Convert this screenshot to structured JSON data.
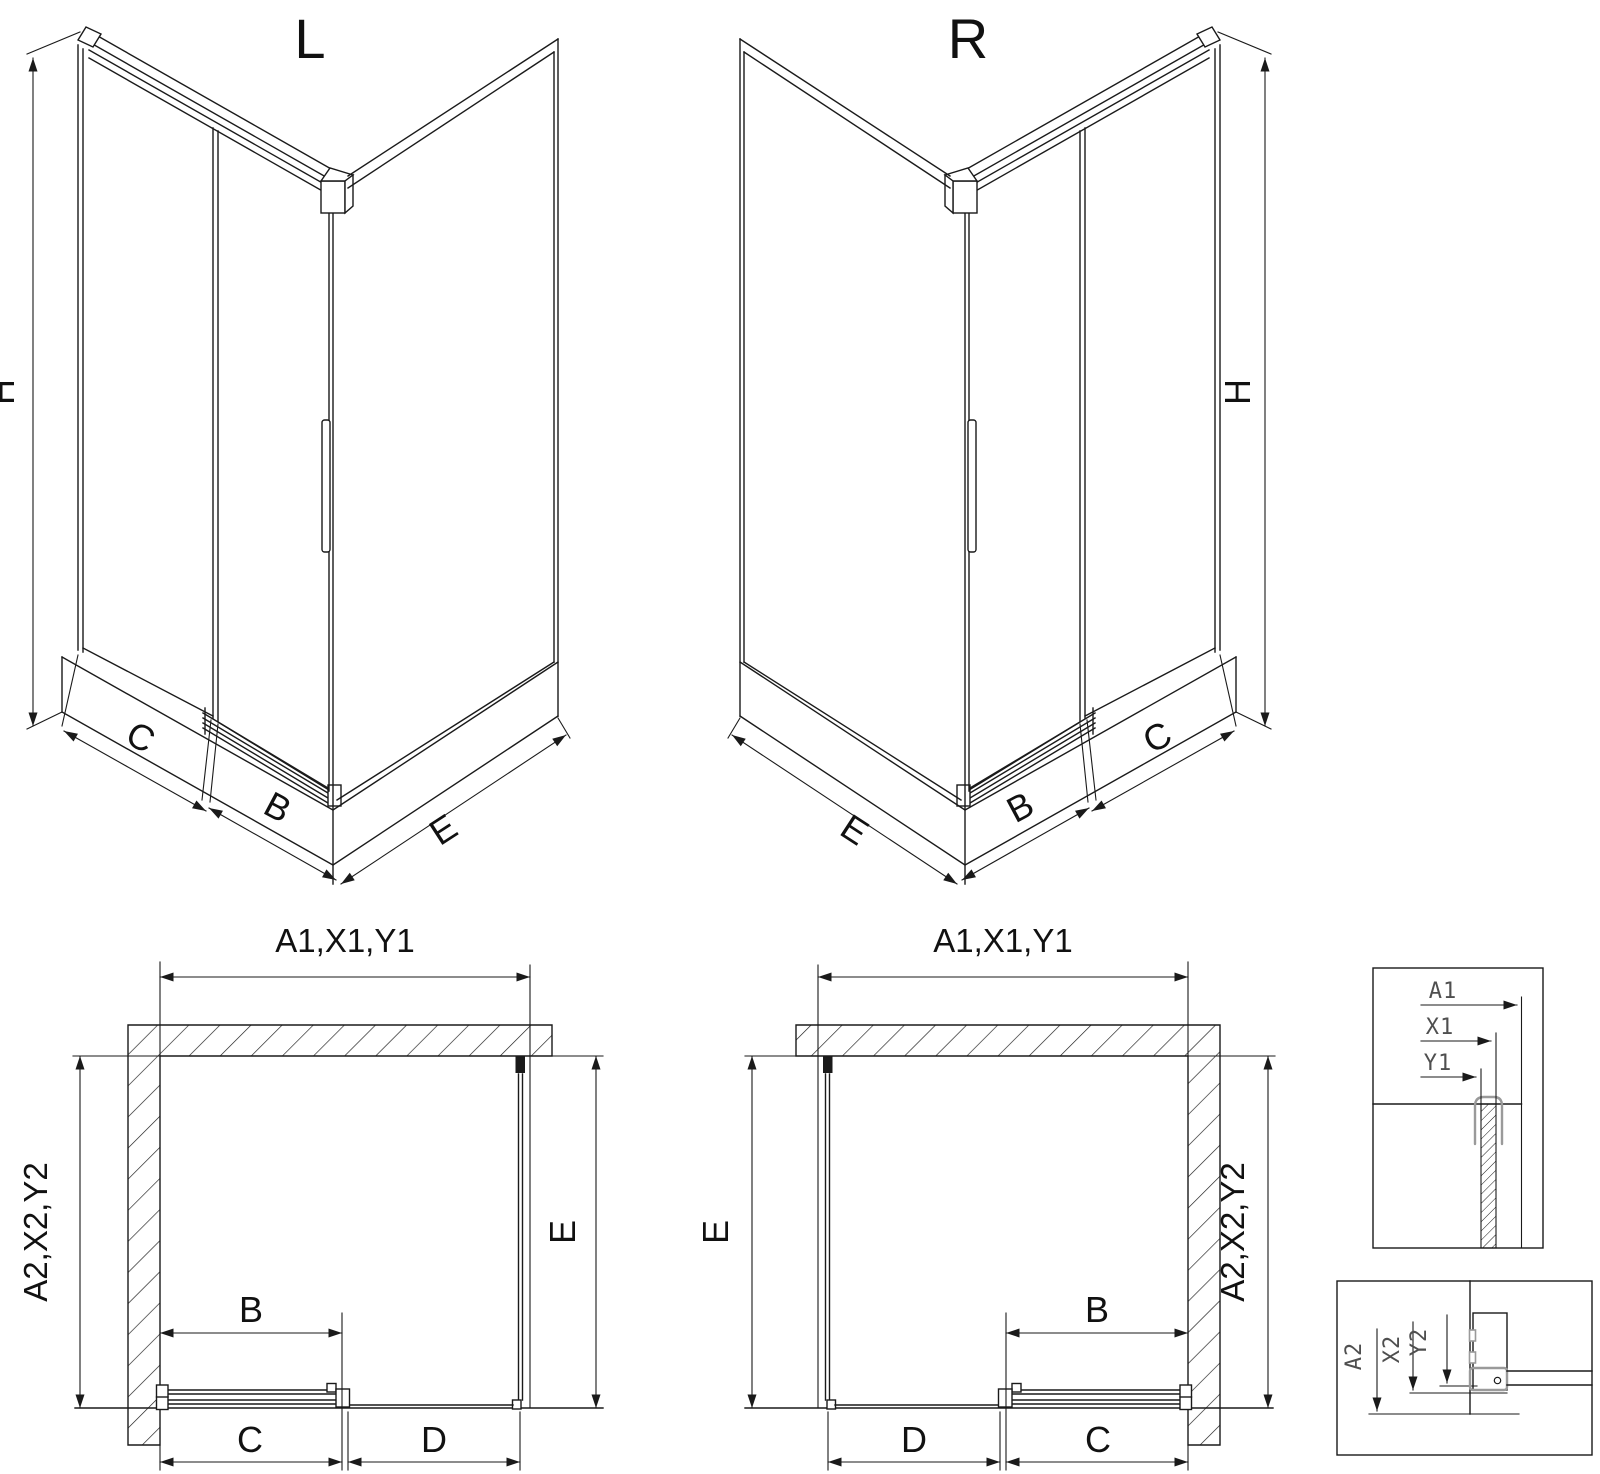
{
  "titles": {
    "left": "L",
    "right": "R"
  },
  "labels": {
    "H": "H",
    "B": "B",
    "C": "C",
    "D": "D",
    "E": "E",
    "top_dim": "A1,X1,Y1",
    "side_dim": "A2,X2,Y2"
  },
  "details": {
    "top": {
      "a1": "A1",
      "x1": "X1",
      "y1": "Y1"
    },
    "bottom": {
      "a2": "A2",
      "x2": "X2",
      "y2": "Y2"
    }
  },
  "colors": {
    "line": "#1a1a1a",
    "detail_gray": "#9a9a9a",
    "detail_label_gray": "#4f4f4f",
    "background": "#ffffff"
  }
}
